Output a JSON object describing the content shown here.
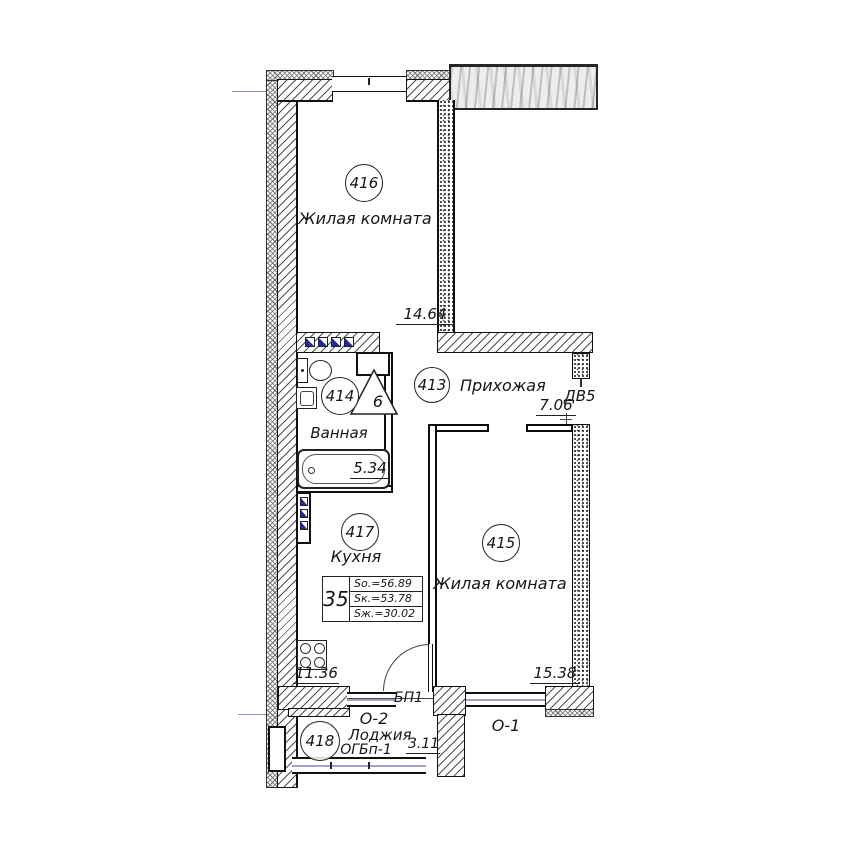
{
  "plan": {
    "rooms": {
      "r416": {
        "number": "416",
        "name": "Жилая комната",
        "area": "14.64"
      },
      "r413": {
        "number": "413",
        "name": "Прихожая",
        "area": "7.06"
      },
      "r414": {
        "number": "414",
        "name": "Ванная",
        "area": "5.34"
      },
      "r417": {
        "number": "417",
        "name": "Кухня",
        "area": "11.36"
      },
      "r415": {
        "number": "415",
        "name": "Жилая комната",
        "area": "15.38"
      },
      "r418": {
        "number": "418",
        "name": "Лоджия",
        "area": "3.11"
      }
    },
    "openings": {
      "door_dv5": "ДВ5",
      "door_bp1": "БП1",
      "window_o1": "О-1",
      "window_o2": "О-2",
      "loggia_glazing": "ОГБп-1"
    },
    "vent_duct": "6",
    "apartment": {
      "number": "35",
      "total_area": "Sо.=56.89",
      "apartment_area": "Sк.=53.78",
      "living_area": "Sж.=30.02"
    },
    "colors": {
      "wall_line": "#111111",
      "axis_accent": "#9090cc",
      "radiator_blue": "#2525a8",
      "glazing": "#a2a2d2"
    }
  }
}
